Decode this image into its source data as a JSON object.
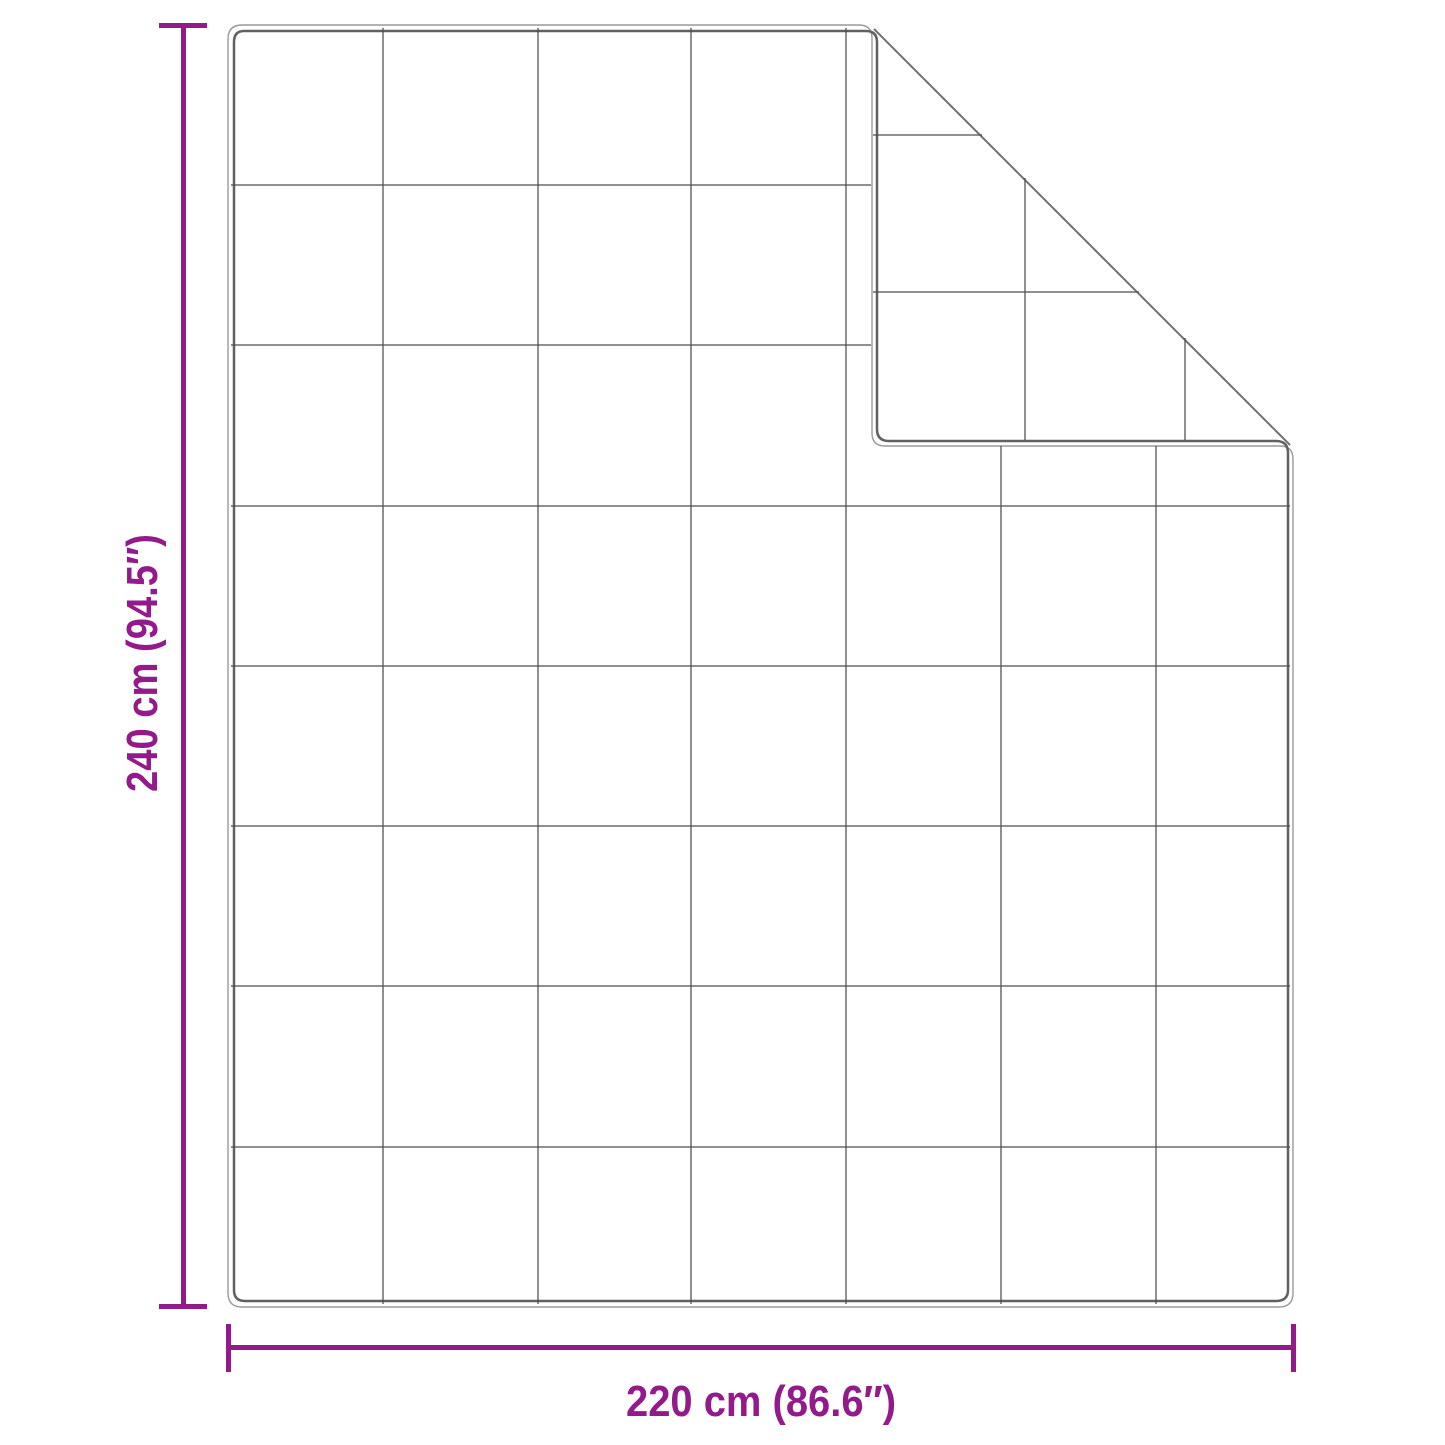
{
  "diagram": {
    "type": "product-dimension-diagram",
    "subject": "quilted blanket with folded top-right corner",
    "width_label": "220 cm (86.6″)",
    "height_label": "240 cm (94.5″)",
    "dimensions": {
      "width_cm": 220,
      "width_inches": 86.6,
      "height_cm": 240,
      "height_inches": 94.5
    },
    "quilt_grid": {
      "columns": 7,
      "rows": 8,
      "folded_corner": "top-right"
    },
    "colors": {
      "dimension_accent": "#921A8A",
      "blanket_edge_outer": "#9A9A9A",
      "blanket_edge_inner": "#616161",
      "quilt_seam": "#4E4E4E",
      "fold_crease": "#707070",
      "background": "#FFFFFF"
    }
  }
}
